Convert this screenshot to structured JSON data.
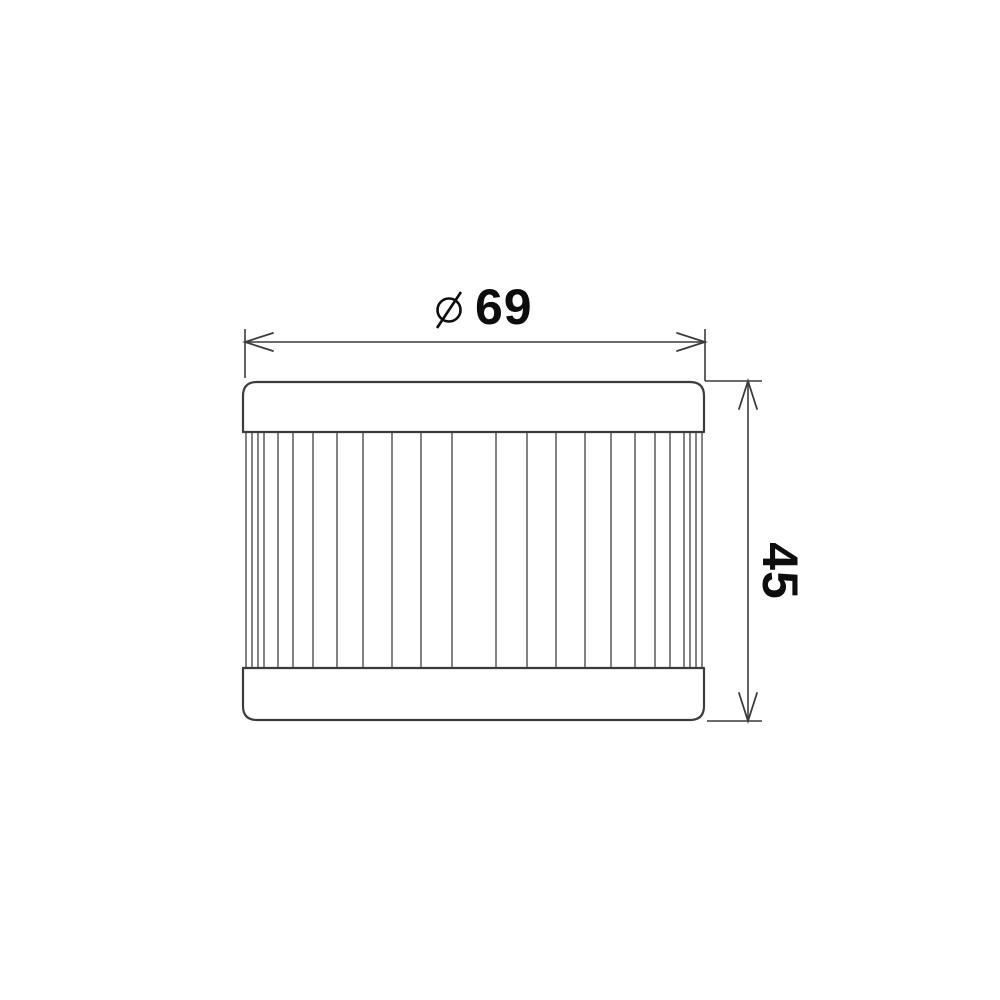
{
  "drawing": {
    "title": "Oil filter element technical drawing",
    "dimensions": {
      "diameter": {
        "symbol": "diameter-sign",
        "value": "69"
      },
      "height": {
        "value": "45"
      }
    },
    "colors": {
      "line": "#3c3c3c",
      "pleat": "#4d4d4d",
      "text": "#0d0d0d",
      "background": "#ffffff"
    },
    "pleats": {
      "count": 24,
      "x_positions": [
        246,
        252,
        258,
        264,
        278,
        293,
        313,
        337,
        363,
        392,
        421,
        452,
        496,
        527,
        556,
        585,
        611,
        635,
        655,
        670,
        684,
        690,
        696,
        702
      ],
      "y_top": 432,
      "y_bottom": 668
    }
  }
}
